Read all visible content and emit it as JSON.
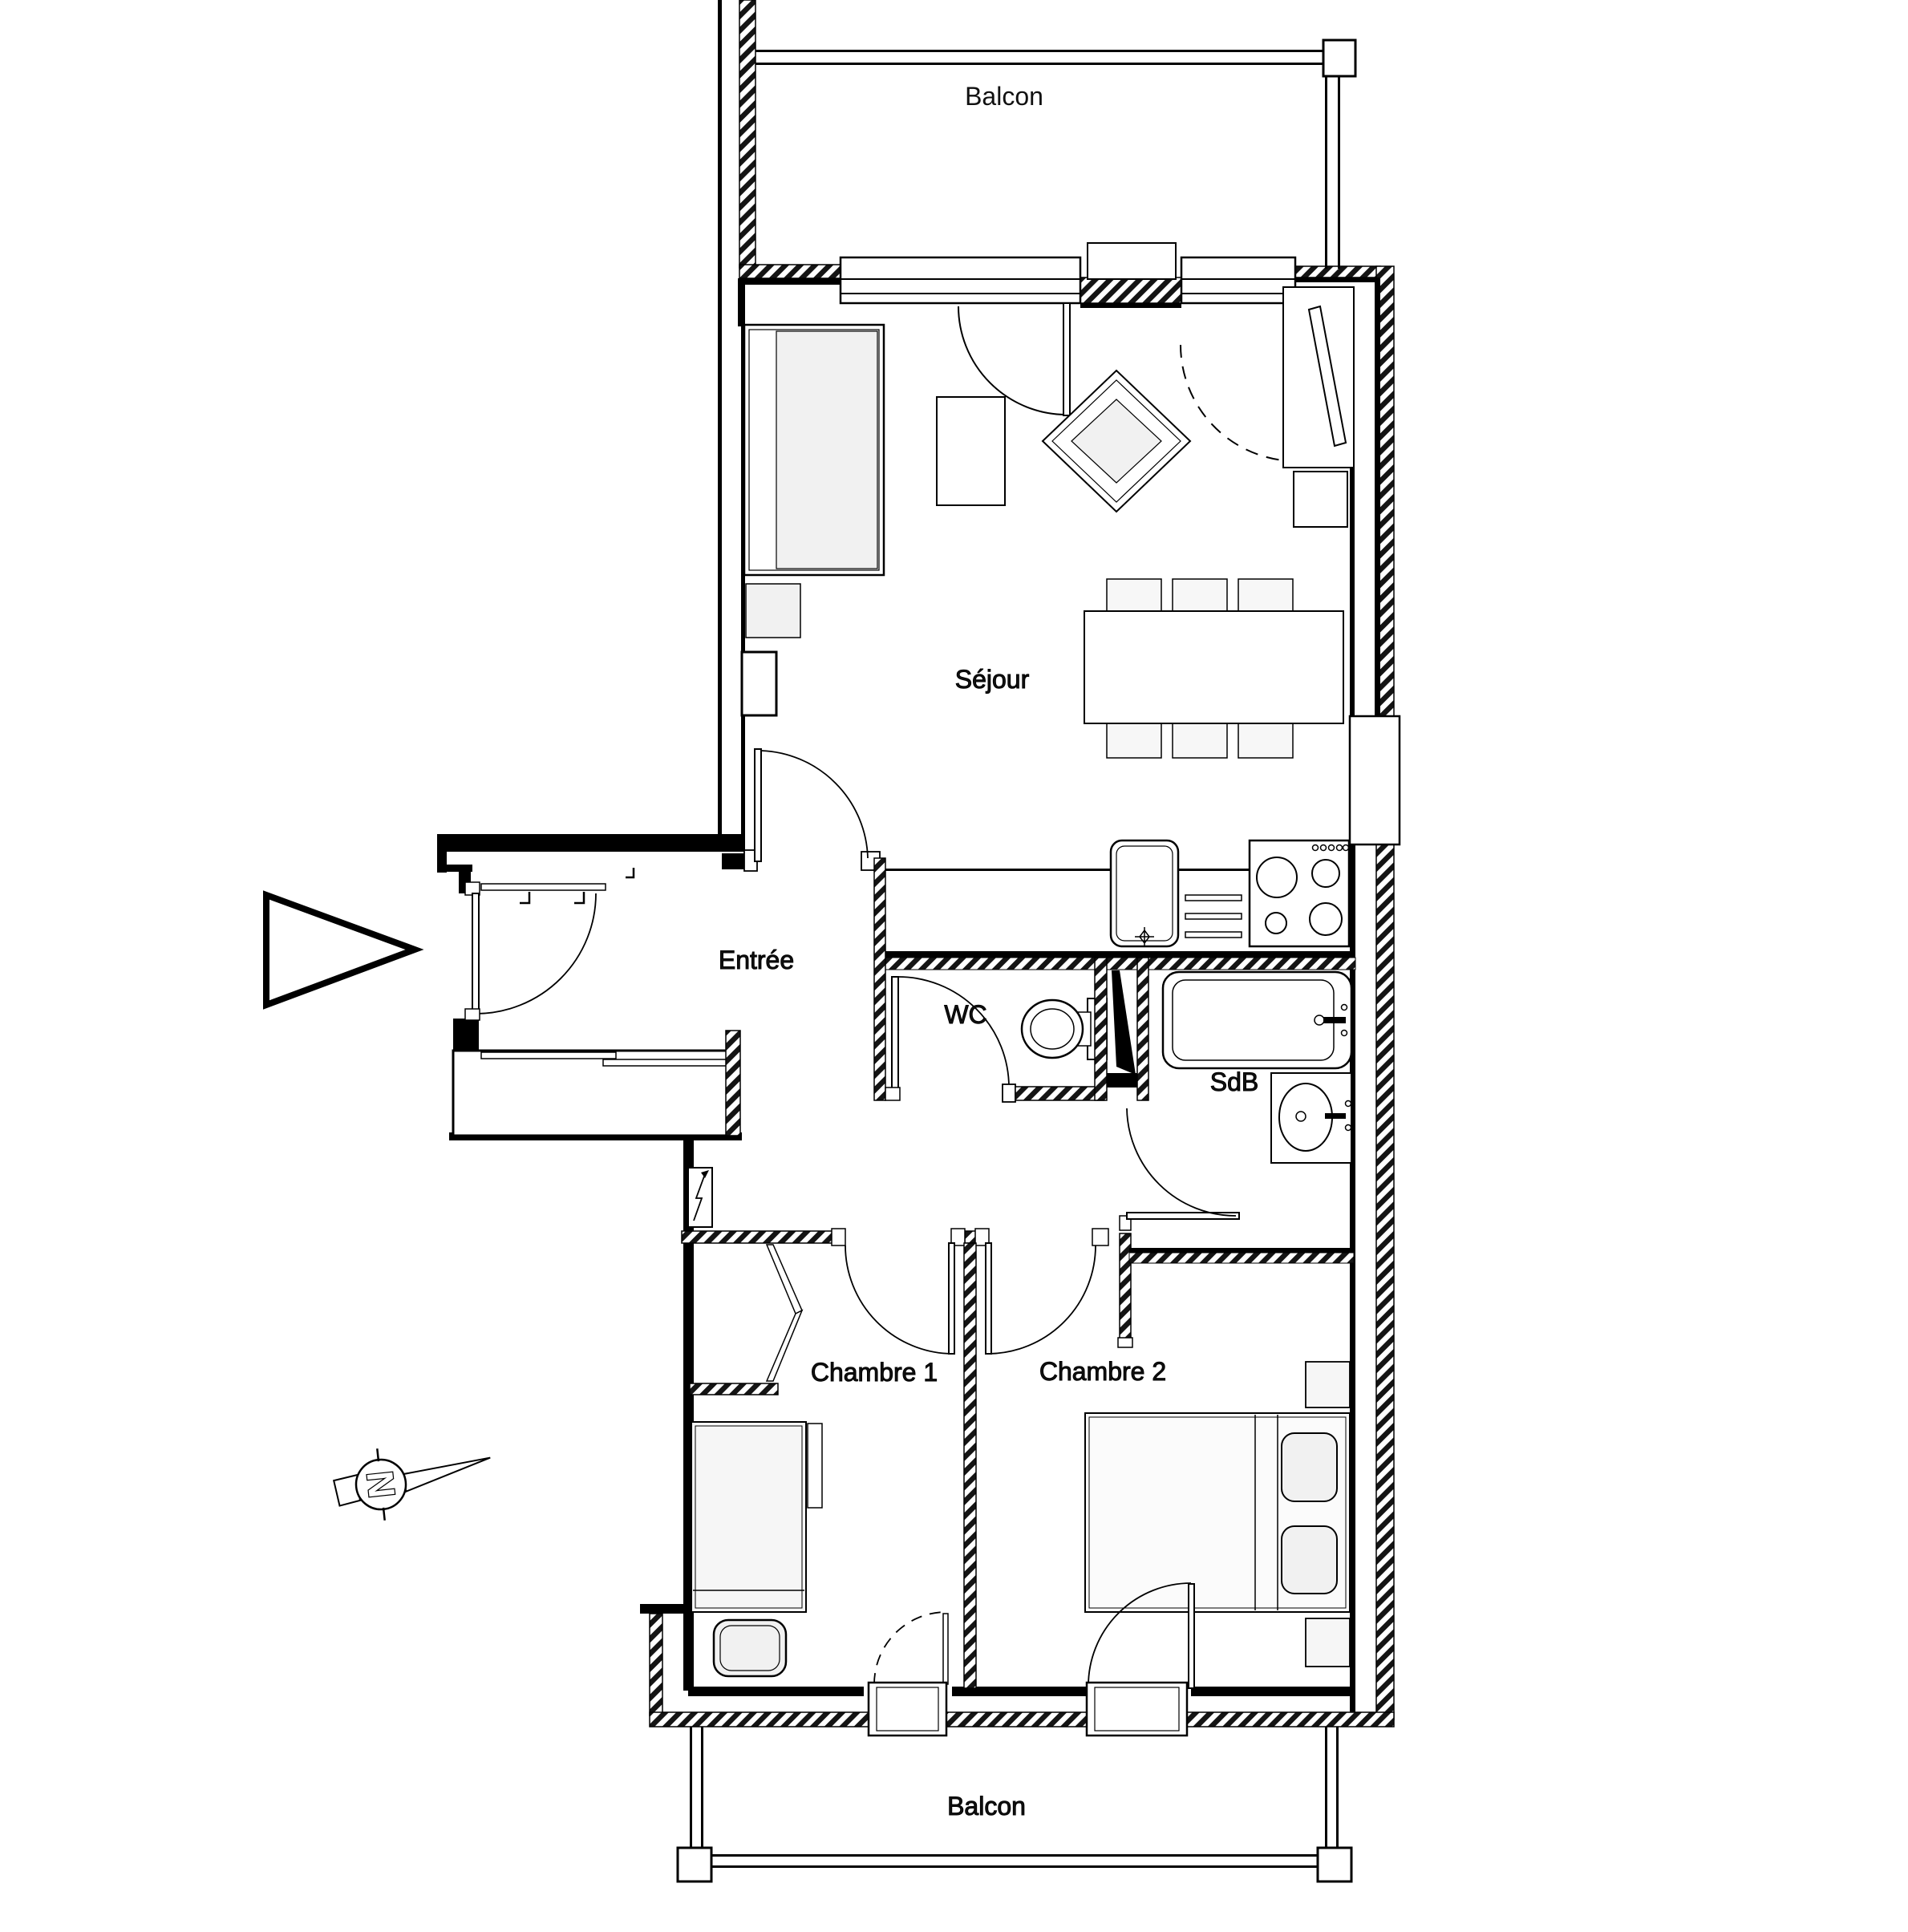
{
  "plan": {
    "type": "apartment-floor-plan",
    "colors": {
      "line": "#000000",
      "background": "#ffffff",
      "furniture_fill": "#f1f1f1"
    },
    "labels": {
      "balcony_top": "Balcon",
      "living_room": "Séjour",
      "entry": "Entrée",
      "wc": "WC",
      "bathroom": "SdB",
      "bedroom1": "Chambre 1",
      "bedroom2": "Chambre 2",
      "balcony_bottom": "Balcon",
      "north_letter": "N"
    }
  }
}
